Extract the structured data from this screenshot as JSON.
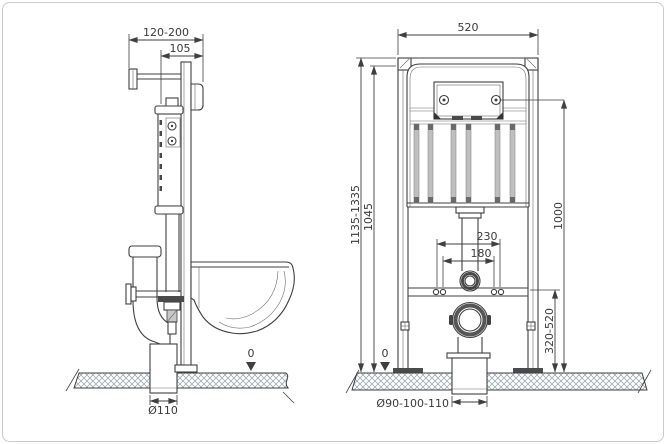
{
  "side_view": {
    "dim_wall_distance": "120-200",
    "dim_depth": "105",
    "dim_floor_level": "0",
    "dim_drain_diameter": "Ø110"
  },
  "front_view": {
    "dim_width": "520",
    "dim_height": "1135-1335",
    "dim_height_secondary": "1045",
    "dim_flush_plate_center": "1000",
    "dim_fixing_outer": "230",
    "dim_fixing_inner": "180",
    "dim_outlet_height": "320-520",
    "dim_floor_level": "0",
    "dim_outlet_diameter": "Ø90-100-110"
  },
  "colors": {
    "line": "#3f3f3f",
    "light_fill": "#bfbfbf",
    "dark_fill": "#4a4a4a",
    "hatch": "#8fa0a5",
    "sheet_border": "#cbcbcb",
    "background": "#ffffff"
  }
}
